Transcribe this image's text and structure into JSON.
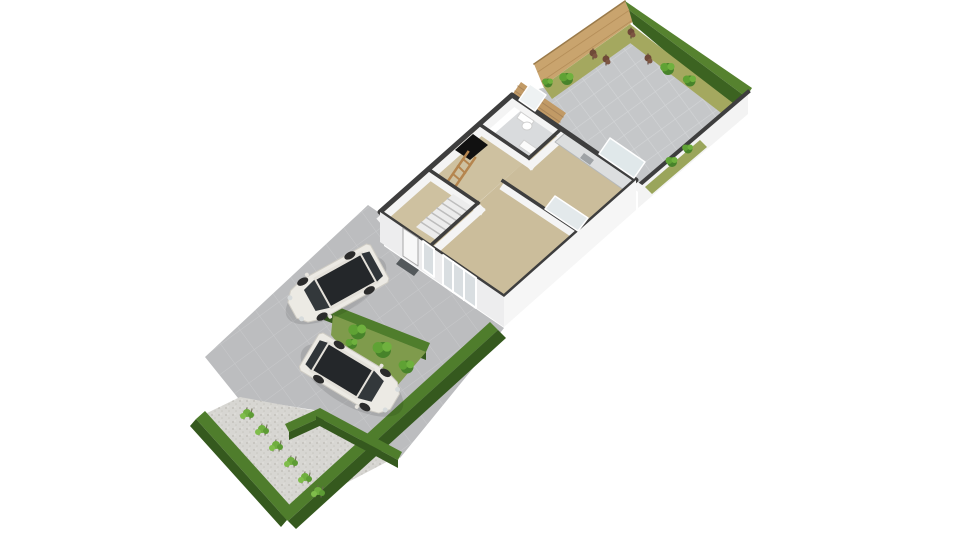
{
  "view": {
    "width": 960,
    "height": 540,
    "background": "#ffffff"
  },
  "palette": {
    "patio_gray": "#c5c7c9",
    "driveway_gray": "#bcbdbf",
    "gravel": "#d7d6d2",
    "hedge_top": "#4f7d2c",
    "hedge_side": "#35591e",
    "grass_strip": "#a4a85f",
    "lawn_patch": "#7f9b4c",
    "fence_wood": "#c9a46e",
    "deck_wood": "#c19a66",
    "wall_cut": "#3e3e3e",
    "wall_face": "#ededee",
    "floor_tan": "#cbbd9b",
    "bath_floor": "#d9dbdd",
    "glass": "#d9dee1",
    "car_body": "#eceae4",
    "car_glass": "#24272a",
    "hatch_black": "#111111",
    "ladder_wood": "#b5854e"
  },
  "scene": {
    "car_parts": [
      {
        "type": "polygon",
        "name": "car-body",
        "points": "-50,-19 -47,-22 28,-22 42,-18 50,-9 50,9 42,18 28,22 -47,22 -50,19",
        "fill": "#eceae4",
        "stroke": "#cfccc4",
        "sw": 1
      },
      {
        "type": "polygon",
        "name": "car-roof-rim",
        "points": "-40,-18 16,-18 16,18 -40,18",
        "fill": "#e4e1da"
      },
      {
        "type": "polygon",
        "name": "car-windshield",
        "points": "16,-16 30,-12 30,12 16,16",
        "fill": "#33383b"
      },
      {
        "type": "polygon",
        "name": "car-roof-glass",
        "points": "-36,-15 14,-15 14,15 -36,15",
        "fill": "#24272a"
      },
      {
        "type": "polygon",
        "name": "car-rear-window",
        "points": "-46,-14 -38,-16 -38,16 -46,14",
        "fill": "#303539"
      },
      {
        "type": "ellipse",
        "name": "car-wheel",
        "cx": 27,
        "cy": -20,
        "rx": 6,
        "ry": 3.5,
        "fill": "#2b2b2b"
      },
      {
        "type": "ellipse",
        "name": "car-wheel",
        "cx": 27,
        "cy": 20,
        "rx": 6,
        "ry": 3.5,
        "fill": "#2b2b2b"
      },
      {
        "type": "ellipse",
        "name": "car-wheel",
        "cx": -27,
        "cy": -20,
        "rx": 6,
        "ry": 3.5,
        "fill": "#2b2b2b"
      },
      {
        "type": "ellipse",
        "name": "car-wheel",
        "cx": -27,
        "cy": 20,
        "rx": 6,
        "ry": 3.5,
        "fill": "#2b2b2b"
      },
      {
        "type": "circle",
        "name": "car-headlight",
        "cx": 46,
        "cy": -12,
        "r": 2.5,
        "fill": "#d7dbdc"
      },
      {
        "type": "circle",
        "name": "car-headlight",
        "cx": 46,
        "cy": 12,
        "r": 2.5,
        "fill": "#d7dbdc"
      },
      {
        "type": "circle",
        "name": "car-mirror",
        "cx": 20,
        "cy": -24,
        "r": 2,
        "fill": "#e8e5df"
      },
      {
        "type": "circle",
        "name": "car-mirror",
        "cx": 20,
        "cy": 24,
        "r": 2,
        "fill": "#e8e5df"
      }
    ],
    "shapes": [
      {
        "type": "polygon",
        "name": "garden-fence",
        "points": "534,64 625,1 634,21 543,86",
        "fill": "url(#wood)"
      },
      {
        "type": "line",
        "name": "garden-fence-top-edge",
        "x1": 534,
        "y1": 64,
        "x2": 625,
        "y2": 1,
        "stroke": "#9a7a4a",
        "sw": 1.5
      },
      {
        "type": "polygon",
        "name": "hedge-north-top",
        "points": "625,1 752,88 746,97 629,10",
        "fill": "#56822f"
      },
      {
        "type": "polygon",
        "name": "hedge-north-side",
        "points": "629,10 746,97 737,112 633,24",
        "fill": "#3c6321"
      },
      {
        "type": "polygon",
        "name": "back-garden-patio",
        "points": "543,88 630,26 742,110 638,186 636,180 512,95",
        "fill": "url(#patio)"
      },
      {
        "type": "polygon",
        "name": "grass-strip-fence",
        "points": "543,86 630,24 639,37 552,99",
        "fill": "#a4a85f"
      },
      {
        "type": "polygon",
        "name": "grass-strip-hedge",
        "points": "630,24 742,110 733,122 621,36",
        "fill": "#a4a85f"
      },
      {
        "type": "polygon",
        "name": "boundary-wall-face",
        "points": "748,92 638,186 638,208 748,114",
        "fill": "#f3f3f3"
      },
      {
        "type": "line",
        "name": "boundary-wall-top",
        "x1": 748,
        "y1": 92,
        "x2": 638,
        "y2": 186,
        "stroke": "#3e3e3e",
        "sw": 4
      },
      {
        "type": "polygon",
        "name": "grass-strip-wall",
        "points": "700,140 645,187 652,194 707,147",
        "fill": "#9aa55b"
      },
      {
        "type": "bush",
        "name": "climbing-plant",
        "x": 672,
        "y": 162,
        "s": 1.0
      },
      {
        "type": "bush",
        "name": "climbing-plant",
        "x": 688,
        "y": 149,
        "s": 0.9
      },
      {
        "type": "brownplant",
        "name": "garden-plant-brown",
        "x": 593,
        "y": 55
      },
      {
        "type": "brownplant",
        "name": "garden-plant-brown",
        "x": 606,
        "y": 61
      },
      {
        "type": "brownplant",
        "name": "garden-plant-brown",
        "x": 631,
        "y": 34
      },
      {
        "type": "brownplant",
        "name": "garden-plant-brown",
        "x": 648,
        "y": 60
      },
      {
        "type": "bush",
        "name": "garden-shrub",
        "x": 567,
        "y": 79,
        "s": 1.2
      },
      {
        "type": "bush",
        "name": "garden-shrub",
        "x": 548,
        "y": 83,
        "s": 0.9
      },
      {
        "type": "bush",
        "name": "garden-shrub",
        "x": 668,
        "y": 69,
        "s": 1.2
      },
      {
        "type": "bush",
        "name": "garden-shrub",
        "x": 690,
        "y": 81,
        "s": 1.1
      },
      {
        "type": "polygon",
        "name": "driveway",
        "points": "205,357 368,205 384,216 384,246 504,328 470,372 400,458 314,410 238,398",
        "fill": "url(#drive)"
      },
      {
        "type": "polygon",
        "name": "gravel-garden",
        "points": "240,397 316,411 398,456 291,512 205,414",
        "fill": "url(#gravel)"
      },
      {
        "type": "polygon",
        "name": "hedge-southwest-top",
        "points": "196,419 287,520 296,512 205,411",
        "fill": "#4f7d2c"
      },
      {
        "type": "polygon",
        "name": "hedge-southwest-side",
        "points": "196,419 287,520 281,527 190,426",
        "fill": "#35591e"
      },
      {
        "type": "polygon",
        "name": "hedge-southeast-top",
        "points": "288,521 498,330 490,322 280,513",
        "fill": "#4f7d2c"
      },
      {
        "type": "polygon",
        "name": "hedge-southeast-side",
        "points": "288,521 498,330 506,338 296,529",
        "fill": "#35591e"
      },
      {
        "type": "polygon",
        "name": "hedge-inner-arm-a-top",
        "points": "285,424 320,408 324,416 289,432",
        "fill": "#4f7d2c"
      },
      {
        "type": "polygon",
        "name": "hedge-inner-arm-a-side",
        "points": "289,432 324,416 324,424 289,440",
        "fill": "#35591e"
      },
      {
        "type": "polygon",
        "name": "hedge-inner-arm-b-top",
        "points": "320,408 402,452 398,460 316,416",
        "fill": "#4f7d2c"
      },
      {
        "type": "polygon",
        "name": "hedge-inner-arm-b-side",
        "points": "316,416 398,460 398,468 316,424",
        "fill": "#35591e"
      },
      {
        "type": "polygon",
        "name": "hedge-patch-border-top",
        "points": "328,303 430,343 426,352 324,312",
        "fill": "#4f7d2c"
      },
      {
        "type": "polygon",
        "name": "hedge-patch-border-side",
        "points": "324,312 426,352 426,360 324,320",
        "fill": "#35591e"
      },
      {
        "type": "polygon",
        "name": "garden-patch",
        "points": "333,315 426,352 385,400 331,335",
        "fill": "#7f9b4c"
      },
      {
        "type": "bush",
        "name": "patch-bush",
        "x": 358,
        "y": 332,
        "s": 1.5
      },
      {
        "type": "bush",
        "name": "patch-bush",
        "x": 383,
        "y": 350,
        "s": 1.6
      },
      {
        "type": "bush",
        "name": "patch-bush",
        "x": 407,
        "y": 367,
        "s": 1.3
      },
      {
        "type": "bush",
        "name": "patch-bush",
        "x": 352,
        "y": 344,
        "s": 1.0
      },
      {
        "type": "shrub",
        "name": "gravel-shrub",
        "x": 247,
        "y": 415
      },
      {
        "type": "shrub",
        "name": "gravel-shrub",
        "x": 262,
        "y": 431
      },
      {
        "type": "shrub",
        "name": "gravel-shrub",
        "x": 276,
        "y": 447
      },
      {
        "type": "shrub",
        "name": "gravel-shrub",
        "x": 291,
        "y": 463
      },
      {
        "type": "shrub",
        "name": "gravel-shrub",
        "x": 305,
        "y": 479
      },
      {
        "type": "shrub",
        "name": "gravel-shrub",
        "x": 318,
        "y": 493
      },
      {
        "type": "polygon",
        "name": "house-deck",
        "points": "512,95 557,126 566,113 521,82",
        "fill": "#c19a66"
      },
      {
        "type": "line",
        "name": "deck-plank-line",
        "x1": 515,
        "y1": 91,
        "x2": 560,
        "y2": 122,
        "stroke": "#a9855a",
        "sw": 1
      },
      {
        "type": "line",
        "name": "deck-plank-line",
        "x1": 518,
        "y1": 86,
        "x2": 563,
        "y2": 117,
        "stroke": "#a9855a",
        "sw": 1
      },
      {
        "type": "polygon",
        "name": "floor-bathroom",
        "points": "525,107 560,130 529,158 494,134",
        "fill": "#d9dbdd"
      },
      {
        "type": "polygon",
        "name": "floor-bedroom",
        "points": "479,124 529,158 478,203 428,169",
        "fill": "#cec1a0"
      },
      {
        "type": "polygon",
        "name": "floor-hall",
        "points": "428,169 478,203 430,246 380,212",
        "fill": "#cec1a0"
      },
      {
        "type": "polygon",
        "name": "floor-kitchen",
        "points": "560,130 634,181 578,231 503,181",
        "fill": "#cbbd9b"
      },
      {
        "type": "polygon",
        "name": "floor-living-room",
        "points": "503,181 578,231 504,297 430,246",
        "fill": "#cbbd9b"
      },
      {
        "type": "line",
        "name": "wall-face-nw",
        "x1": 514,
        "y1": 102,
        "x2": 382,
        "y2": 219,
        "stroke": "#f4f4f4",
        "sw": 8
      },
      {
        "type": "line",
        "name": "wall-face-ne",
        "x1": 514,
        "y1": 102,
        "x2": 638,
        "y2": 187,
        "stroke": "#f4f4f4",
        "sw": 8
      },
      {
        "type": "line",
        "name": "wall-face-bed-bath",
        "x1": 481,
        "y1": 131,
        "x2": 531,
        "y2": 165,
        "stroke": "#f4f4f4",
        "sw": 8
      },
      {
        "type": "line",
        "name": "wall-face-bath-kitchen",
        "x1": 562,
        "y1": 137,
        "x2": 531,
        "y2": 165,
        "stroke": "#f4f4f4",
        "sw": 8
      },
      {
        "type": "line",
        "name": "wall-face-kitchen-living",
        "x1": 505,
        "y1": 188,
        "x2": 580,
        "y2": 238,
        "stroke": "#f4f4f4",
        "sw": 8
      },
      {
        "type": "line",
        "name": "wall-face-bed-hall",
        "x1": 430,
        "y1": 176,
        "x2": 480,
        "y2": 210,
        "stroke": "#f4f4f4",
        "sw": 8
      },
      {
        "type": "line",
        "name": "wall-face-hall-living",
        "x1": 480,
        "y1": 210,
        "x2": 432,
        "y2": 253,
        "stroke": "#f4f4f4",
        "sw": 8
      },
      {
        "type": "polygon",
        "name": "kitchen-counter",
        "points": "565,133 634,181 624,190 555,142",
        "fill": "#dcdedf",
        "stroke": "#b5b8ba",
        "sw": 1
      },
      {
        "type": "polygon",
        "name": "kitchen-sink",
        "points": "584,153 594,160 590,165 580,158",
        "fill": "#9fa3a6"
      },
      {
        "type": "polygon",
        "name": "staircase",
        "points": "453,194 473,207 436,240 416,227",
        "fill": "#ececec"
      },
      {
        "type": "line",
        "name": "stair-step",
        "x1": 447.7,
        "y1": 198.7,
        "x2": 467.7,
        "y2": 211.7,
        "stroke": "#bdbdbd",
        "sw": 1.5
      },
      {
        "type": "line",
        "name": "stair-step",
        "x1": 442.4,
        "y1": 203.4,
        "x2": 462.4,
        "y2": 216.4,
        "stroke": "#bdbdbd",
        "sw": 1.5
      },
      {
        "type": "line",
        "name": "stair-step",
        "x1": 437.1,
        "y1": 208.1,
        "x2": 457.1,
        "y2": 221.1,
        "stroke": "#bdbdbd",
        "sw": 1.5
      },
      {
        "type": "line",
        "name": "stair-step",
        "x1": 431.9,
        "y1": 212.9,
        "x2": 451.9,
        "y2": 225.9,
        "stroke": "#bdbdbd",
        "sw": 1.5
      },
      {
        "type": "line",
        "name": "stair-step",
        "x1": 426.6,
        "y1": 217.6,
        "x2": 446.6,
        "y2": 230.6,
        "stroke": "#bdbdbd",
        "sw": 1.5
      },
      {
        "type": "line",
        "name": "stair-step",
        "x1": 421.3,
        "y1": 222.3,
        "x2": 441.3,
        "y2": 235.3,
        "stroke": "#bdbdbd",
        "sw": 1.5
      },
      {
        "type": "polygon",
        "name": "loft-hatch",
        "points": "473,134 488,145 470,160 455,150",
        "fill": "#111111"
      },
      {
        "type": "line",
        "name": "loft-ladder-rail",
        "x1": 468,
        "y1": 152,
        "x2": 448,
        "y2": 181,
        "stroke": "#b5854e",
        "sw": 2.5
      },
      {
        "type": "line",
        "name": "loft-ladder-rail",
        "x1": 475,
        "y1": 158,
        "x2": 455,
        "y2": 187,
        "stroke": "#b5854e",
        "sw": 2.5
      },
      {
        "type": "line",
        "name": "loft-ladder-rung",
        "x1": 463,
        "y1": 159,
        "x2": 470,
        "y2": 165,
        "stroke": "#b5854e",
        "sw": 2
      },
      {
        "type": "line",
        "name": "loft-ladder-rung",
        "x1": 458,
        "y1": 166,
        "x2": 465,
        "y2": 173,
        "stroke": "#b5854e",
        "sw": 2
      },
      {
        "type": "line",
        "name": "loft-ladder-rung",
        "x1": 453,
        "y1": 174,
        "x2": 460,
        "y2": 180,
        "stroke": "#b5854e",
        "sw": 2
      },
      {
        "type": "polygon",
        "name": "toilet-tank",
        "points": "521,112 534,121 530,127 517,118",
        "fill": "#ffffff",
        "stroke": "#cfcfcf",
        "sw": 1
      },
      {
        "type": "ellipse",
        "name": "toilet-bowl",
        "cx": 527,
        "cy": 126,
        "rx": 5,
        "ry": 4,
        "fill": "#ffffff",
        "stroke": "#cfcfcf",
        "sw": 1
      },
      {
        "type": "polygon",
        "name": "washbasin",
        "points": "524,140 537,149 532,155 519,146",
        "fill": "#fbfbfb",
        "stroke": "#d0d0d0",
        "sw": 1
      },
      {
        "type": "polygon",
        "name": "house-wall-outline",
        "points": "512,95 636,180 504,297 380,212",
        "fill": "none",
        "stroke": "#3e3e3e",
        "sw": 5
      },
      {
        "type": "line",
        "name": "wall-bed-bath",
        "x1": 479,
        "y1": 124,
        "x2": 529,
        "y2": 158,
        "stroke": "#3e3e3e",
        "sw": 3.5
      },
      {
        "type": "line",
        "name": "wall-bath-kitchen",
        "x1": 560,
        "y1": 130,
        "x2": 529,
        "y2": 158,
        "stroke": "#3e3e3e",
        "sw": 3.5
      },
      {
        "type": "line",
        "name": "wall-kitchen-living",
        "x1": 503,
        "y1": 181,
        "x2": 578,
        "y2": 231,
        "stroke": "#3e3e3e",
        "sw": 3.5
      },
      {
        "type": "line",
        "name": "wall-bed-hall",
        "x1": 428,
        "y1": 169,
        "x2": 478,
        "y2": 203,
        "stroke": "#3e3e3e",
        "sw": 3.5
      },
      {
        "type": "line",
        "name": "wall-hall-living",
        "x1": 478,
        "y1": 203,
        "x2": 430,
        "y2": 246,
        "stroke": "#3e3e3e",
        "sw": 3.5
      },
      {
        "type": "polygon",
        "name": "bathroom-window",
        "points": "519,100 535,111 546,95 530,84",
        "fill": "#eef2f3",
        "stroke": "#ffffff",
        "sw": 1.5
      },
      {
        "type": "polygon",
        "name": "kitchen-sliding-door",
        "points": "599,154 634,178 645,162 610,138",
        "fill": "#e0e8ea",
        "stroke": "#ffffff",
        "sw": 1.5
      },
      {
        "type": "polygon",
        "name": "kitchen-interior-glass-door",
        "points": "545,209 578,231 588,218 555,196",
        "fill": "#e3e9eb",
        "stroke": "#ffffff",
        "sw": 1.5
      },
      {
        "type": "polygon",
        "name": "house-facade-southwest",
        "points": "380,212 504,297 504,327 380,242",
        "fill": "#ededee"
      },
      {
        "type": "polygon",
        "name": "house-facade-southeast",
        "points": "504,297 636,180 636,210 504,327",
        "fill": "#f6f6f6"
      },
      {
        "type": "polygon",
        "name": "front-door",
        "points": "403,228 418,238 418,266 403,256",
        "fill": "#f8f8f8",
        "stroke": "#a8a8a8",
        "sw": 1
      },
      {
        "type": "polygon",
        "name": "doormat",
        "points": "401,258 419,270 414,276 396,264",
        "fill": "#53585b"
      },
      {
        "type": "polygon",
        "name": "facade-window-small",
        "points": "423,241 434,249 434,277 423,269",
        "fill": "#d9dee1",
        "stroke": "#ffffff",
        "sw": 2
      },
      {
        "type": "polygon",
        "name": "facade-window-large",
        "points": "443,255 476,278 476,308 443,285",
        "fill": "#d9dee1",
        "stroke": "#ffffff",
        "sw": 2
      },
      {
        "type": "line",
        "name": "window-mullion",
        "x1": 453,
        "y1": 262,
        "x2": 453,
        "y2": 292,
        "stroke": "#ffffff",
        "sw": 2
      },
      {
        "type": "line",
        "name": "window-mullion",
        "x1": 464,
        "y1": 270,
        "x2": 464,
        "y2": 300,
        "stroke": "#ffffff",
        "sw": 2
      },
      {
        "type": "ellipse",
        "name": "car-shadow",
        "cx": 336,
        "cy": 290,
        "rx": 56,
        "ry": 24,
        "fill": "rgba(0,0,0,0.10)",
        "transform": "rotate(-29 336 290)"
      },
      {
        "type": "car",
        "name": "car-white-minivan-1",
        "transform": "translate(336,286) rotate(151)"
      },
      {
        "type": "ellipse",
        "name": "car-shadow",
        "cx": 352,
        "cy": 380,
        "rx": 58,
        "ry": 25,
        "fill": "rgba(0,0,0,0.10)",
        "transform": "rotate(31 352 380)"
      },
      {
        "type": "car",
        "name": "car-white-minivan-2",
        "transform": "translate(352,376) rotate(31)"
      }
    ]
  }
}
